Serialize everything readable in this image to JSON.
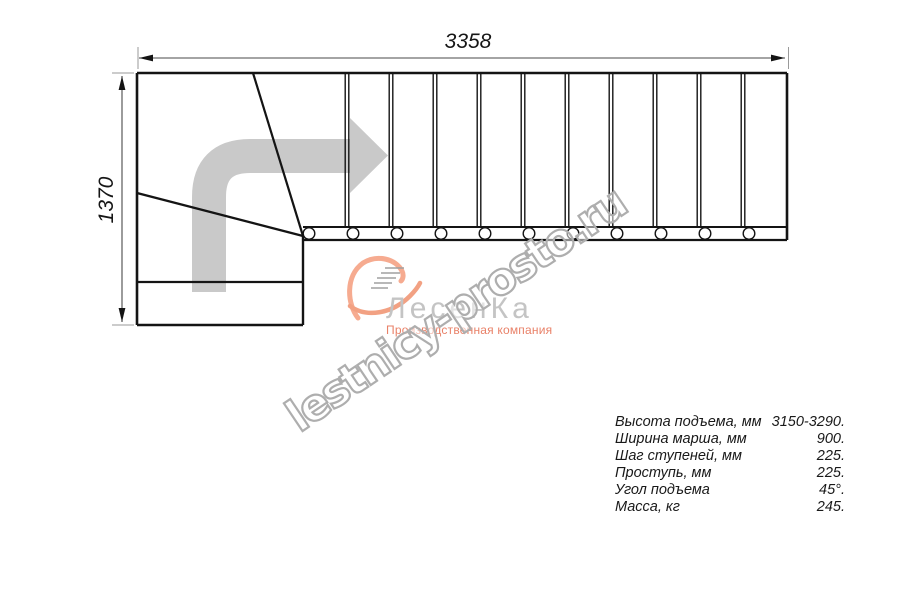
{
  "dimensions": {
    "width_label": "3358",
    "height_label": "1370"
  },
  "logo": {
    "company": "ЛесенКа",
    "tagline": "Производственная компания",
    "swoosh_color": "#f6ab90",
    "tail_color": "#f2a183",
    "steps_color": "#a0a0a0",
    "company_color": "#c4c4c4",
    "tagline_color": "#e98168"
  },
  "watermark": {
    "text": "lestnicy-prosto.ru",
    "stroke_color": "#aeaeae"
  },
  "specs": {
    "rows": [
      {
        "label": "Высота подъема, мм",
        "value": "3150-3290."
      },
      {
        "label": "Ширина марша, мм",
        "value": "900."
      },
      {
        "label": "Шаг ступеней, мм",
        "value": "225."
      },
      {
        "label": "Проступь, мм",
        "value": "225."
      },
      {
        "label": "Угол подъема",
        "value": "45°."
      },
      {
        "label": "Масса, кг",
        "value": "245."
      }
    ]
  },
  "diagram": {
    "colors": {
      "line": "#141414",
      "dim": "#4a4a4a",
      "stub": "#9a9a9a",
      "arrow": "#c9c9c9"
    },
    "arrow": {
      "shaft": "M 209 292 L 209 197 Q 209 156 250 156 L 351 156",
      "shaft_width": 34,
      "head_points": "350,118 350,193 388,155.5"
    },
    "plan_segments": [
      [
        137,
        73,
        787,
        73,
        2.6
      ],
      [
        137,
        73,
        137,
        325,
        2.6
      ],
      [
        137,
        325,
        303,
        325,
        2.6
      ],
      [
        137,
        282,
        303,
        282,
        2.2
      ],
      [
        303,
        236,
        303,
        325,
        2.4
      ],
      [
        253,
        73,
        303,
        236,
        2.2
      ],
      [
        137,
        193,
        303,
        236,
        2.2
      ],
      [
        303,
        227,
        787,
        227,
        2.0
      ],
      [
        303,
        240,
        787,
        240,
        2.2
      ],
      [
        787,
        73,
        787,
        240,
        2.6
      ]
    ],
    "treads": {
      "xs": [
        347,
        391,
        435,
        479,
        523,
        567,
        611,
        655,
        699,
        743
      ],
      "y1": 73,
      "y2": 226,
      "pair_offset": 1.8,
      "width": 1.4
    },
    "balusters": {
      "xs": [
        309,
        353,
        397,
        441,
        485,
        529,
        573,
        617,
        661,
        705,
        749
      ],
      "cy": 233.5,
      "r": 5.8,
      "stroke_width": 1.4
    },
    "dim_lines": [
      [
        139,
        58,
        785,
        58
      ],
      [
        122,
        76,
        122,
        322
      ]
    ],
    "dim_stubs": [
      [
        138,
        47,
        138,
        69
      ],
      [
        788.5,
        47,
        788.5,
        69
      ],
      [
        112,
        73,
        134,
        73
      ],
      [
        112,
        325,
        134,
        325
      ]
    ],
    "dim_arrowheads": [
      "139,58 153,54.6 153,61.4",
      "785,58 771,54.6 771,61.4",
      "122,76 118.6,90 125.4,90",
      "122,322 118.6,308 125.4,308"
    ]
  }
}
